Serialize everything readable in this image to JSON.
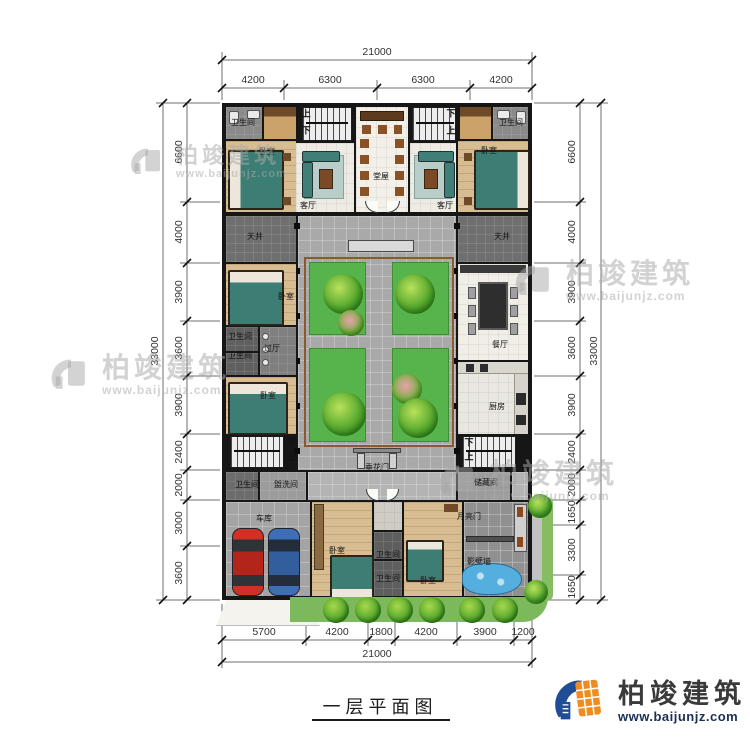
{
  "title": "一层平面图",
  "logo": {
    "brand": "柏竣建筑",
    "url": "www.baijunjz.com"
  },
  "watermark": {
    "brand": "柏竣建筑",
    "url": "www.baijunjz.com"
  },
  "dimensions": {
    "top": {
      "overall": "21000",
      "segments": [
        "4200",
        "6300",
        "6300",
        "4200"
      ]
    },
    "bottom": {
      "overall": "21000",
      "segments": [
        "5700",
        "4200",
        "1800",
        "4200",
        "3900",
        "1200"
      ]
    },
    "left": {
      "overall": "33000",
      "segments": [
        "6600",
        "4000",
        "3900",
        "3600",
        "3900",
        "2400",
        "2000",
        "3000",
        "3600"
      ]
    },
    "right": {
      "overall": "33000",
      "segments": [
        "6600",
        "4000",
        "3900",
        "3600",
        "3900",
        "2400",
        "2000",
        "1650",
        "3300",
        "1650"
      ]
    }
  },
  "stairs": {
    "up": "上",
    "down": "下"
  },
  "rooms": {
    "bathroom": "卫生间",
    "bedroom": "卧室",
    "living_room": "客厅",
    "main_hall": "堂屋",
    "light_well": "天井",
    "hallway": "过厅",
    "dining_room": "餐厅",
    "kitchen": "厨房",
    "festoon_gate": "垂花门",
    "washroom": "盥洗间",
    "storage": "储藏间",
    "moon_gate": "月亮门",
    "garage": "车库",
    "screen_wall": "影壁墙"
  },
  "colors": {
    "wall": "#161616",
    "floor_light": "#edebe4",
    "floor_wood": "#d8bd92",
    "floor_dark": "#6f6f6f",
    "courtyard_paving": "#a9a9a9",
    "lawn_green": "#57b44c",
    "car_red": "#d23023",
    "car_blue": "#3e6fb6",
    "water_blue": "#54aede",
    "logo_blue": "#1f4e96",
    "logo_orange": "#f08c1e"
  }
}
